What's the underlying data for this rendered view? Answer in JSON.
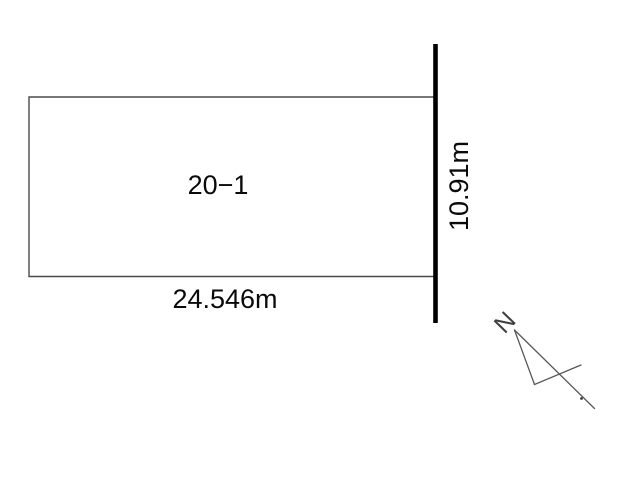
{
  "parcel": {
    "lot_number": "20−1",
    "width_dimension": "24.546m",
    "depth_dimension": "10.91m"
  },
  "compass": {
    "north_label": "N"
  },
  "colors": {
    "background": "#ffffff",
    "parcel_outline": "#4a4a4a",
    "road_boundary": "#000000",
    "text": "#0a0a0a",
    "compass_lines": "#585858"
  }
}
